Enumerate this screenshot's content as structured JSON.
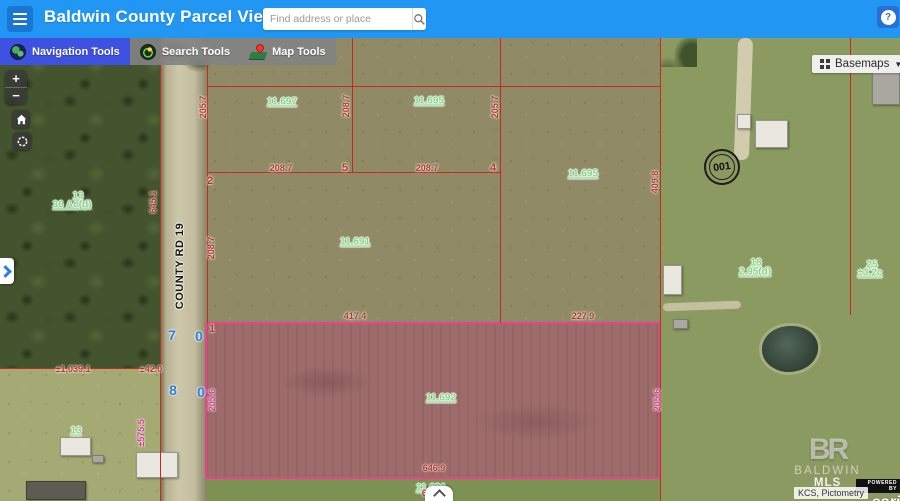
{
  "header": {
    "title": "Baldwin County Parcel Viewer",
    "search_placeholder": "Find address or place",
    "help_glyph": "?"
  },
  "toolbar": {
    "buttons": [
      {
        "label": "Navigation Tools",
        "icon": "globe-icon",
        "active": true
      },
      {
        "label": "Search Tools",
        "icon": "search-globe-icon",
        "active": false
      },
      {
        "label": "Map Tools",
        "icon": "map-pin-icon",
        "active": false
      }
    ]
  },
  "basemaps": {
    "label": "Basemaps",
    "caret": "▼"
  },
  "map_controls": {
    "zoom_in": "+",
    "zoom_out": "−"
  },
  "attribution": {
    "logo_initials": "BR",
    "brand_1": "BALDWIN",
    "brand_2": "MLS",
    "powered_by": "POWERED BY",
    "esri": "esri",
    "sources": "KCS, Pictometry"
  },
  "colors": {
    "header_blue": "#2196f3",
    "active_tool_blue": "#3f51e1",
    "parcel_line_red": "#c8291d",
    "highlight_pink": "#f0408c",
    "parcel_label_green": "#7ed87e",
    "dimension_red": "#b7352b",
    "lot_number_blue": "#2b7de0"
  },
  "map": {
    "road_label": "COUNTY RD 19",
    "marker_001": "001",
    "highlight": {
      "x": 205,
      "y": 322,
      "w": 456,
      "h": 157
    },
    "parcel_lines": [
      {
        "x": 159.5,
        "y": 38,
        "w": 1.5,
        "h": 463
      },
      {
        "x": 206.5,
        "y": 38,
        "w": 1.5,
        "h": 285
      },
      {
        "x": 351.5,
        "y": 38,
        "w": 1.5,
        "h": 134
      },
      {
        "x": 499.5,
        "y": 38,
        "w": 1.5,
        "h": 285
      },
      {
        "x": 659.5,
        "y": 38,
        "w": 1.5,
        "h": 463
      },
      {
        "x": 849.5,
        "y": 38,
        "w": 1.5,
        "h": 277
      },
      {
        "x": 207,
        "y": 85.5,
        "w": 453,
        "h": 1.5
      },
      {
        "x": 207,
        "y": 171.5,
        "w": 294,
        "h": 1.5
      },
      {
        "x": 0,
        "y": 367.5,
        "w": 160,
        "h": 1.5
      }
    ],
    "annotations": [
      {
        "cls": "parcel-link",
        "text": "11.697",
        "x": 282,
        "y": 102
      },
      {
        "cls": "parcel-link",
        "text": "11.695",
        "x": 429,
        "y": 101
      },
      {
        "cls": "parcel-link",
        "text": "11.695",
        "x": 583,
        "y": 174
      },
      {
        "cls": "parcel-link",
        "text": "11.691",
        "x": 355,
        "y": 242
      },
      {
        "cls": "parcel-link",
        "text": "11.692",
        "x": 441,
        "y": 398
      },
      {
        "cls": "parcel-link",
        "text": "11.691",
        "x": 431,
        "y": 488
      },
      {
        "cls": "parcel-link",
        "text": "13",
        "x": 78,
        "y": 196
      },
      {
        "cls": "parcel-link",
        "text": "36 Ac(d)",
        "x": 72,
        "y": 205
      },
      {
        "cls": "parcel-link",
        "text": "13",
        "x": 76,
        "y": 431
      },
      {
        "cls": "parcel-link",
        "text": "18",
        "x": 756,
        "y": 263
      },
      {
        "cls": "parcel-link",
        "text": "2.95(d)",
        "x": 755,
        "y": 272
      },
      {
        "cls": "parcel-link",
        "text": "25",
        "x": 872,
        "y": 265
      },
      {
        "cls": "parcel-link",
        "text": "±3.2c",
        "x": 870,
        "y": 273
      },
      {
        "cls": "dim",
        "text": "205.7",
        "x": 203,
        "y": 107,
        "rot": -90
      },
      {
        "cls": "dim",
        "text": "208.7",
        "x": 346,
        "y": 106,
        "rot": -90
      },
      {
        "cls": "dim",
        "text": "205.7",
        "x": 495,
        "y": 107,
        "rot": -90
      },
      {
        "cls": "dim",
        "text": "208.7",
        "x": 281,
        "y": 168
      },
      {
        "cls": "dim big",
        "text": "5",
        "x": 345,
        "y": 168
      },
      {
        "cls": "dim",
        "text": "208.7",
        "x": 427,
        "y": 168
      },
      {
        "cls": "dim big",
        "text": "4",
        "x": 493,
        "y": 168
      },
      {
        "cls": "dim",
        "text": "409.8",
        "x": 655,
        "y": 182,
        "rot": -90
      },
      {
        "cls": "dim",
        "text": "208.7",
        "x": 211,
        "y": 248,
        "rot": -90
      },
      {
        "cls": "dim",
        "text": "645.1",
        "x": 153,
        "y": 202,
        "rot": -90
      },
      {
        "cls": "dim big",
        "text": "2",
        "x": 210,
        "y": 181
      },
      {
        "cls": "dim",
        "text": "417.4",
        "x": 355,
        "y": 316
      },
      {
        "cls": "dim",
        "text": "227.9",
        "x": 583,
        "y": 316
      },
      {
        "cls": "dim big",
        "text": "1",
        "x": 212,
        "y": 329
      },
      {
        "cls": "dim",
        "text": "646.9",
        "x": 434,
        "y": 468
      },
      {
        "cls": "dim",
        "text": "646.9",
        "x": 433,
        "y": 493
      },
      {
        "cls": "dim",
        "text": "±1,039.1",
        "x": 73,
        "y": 369
      },
      {
        "cls": "dim",
        "text": "±42.0",
        "x": 151,
        "y": 369
      },
      {
        "cls": "dim pink",
        "text": "±575.5",
        "x": 141,
        "y": 433,
        "rot": -90
      },
      {
        "cls": "dim pink",
        "text": "205.6",
        "x": 212,
        "y": 400,
        "rot": -90
      },
      {
        "cls": "dim pink",
        "text": "205.6",
        "x": 657,
        "y": 400,
        "rot": -90
      },
      {
        "cls": "lot-blue",
        "text": "7",
        "x": 172,
        "y": 335
      },
      {
        "cls": "lot-blue",
        "text": "0",
        "x": 199,
        "y": 336
      },
      {
        "cls": "lot-blue",
        "text": "8",
        "x": 173,
        "y": 390
      },
      {
        "cls": "lot-blue",
        "text": "0",
        "x": 201,
        "y": 392
      },
      {
        "cls": "road-label",
        "text": "COUNTY RD 19",
        "x": 180,
        "y": 266,
        "rot": -90
      }
    ]
  }
}
